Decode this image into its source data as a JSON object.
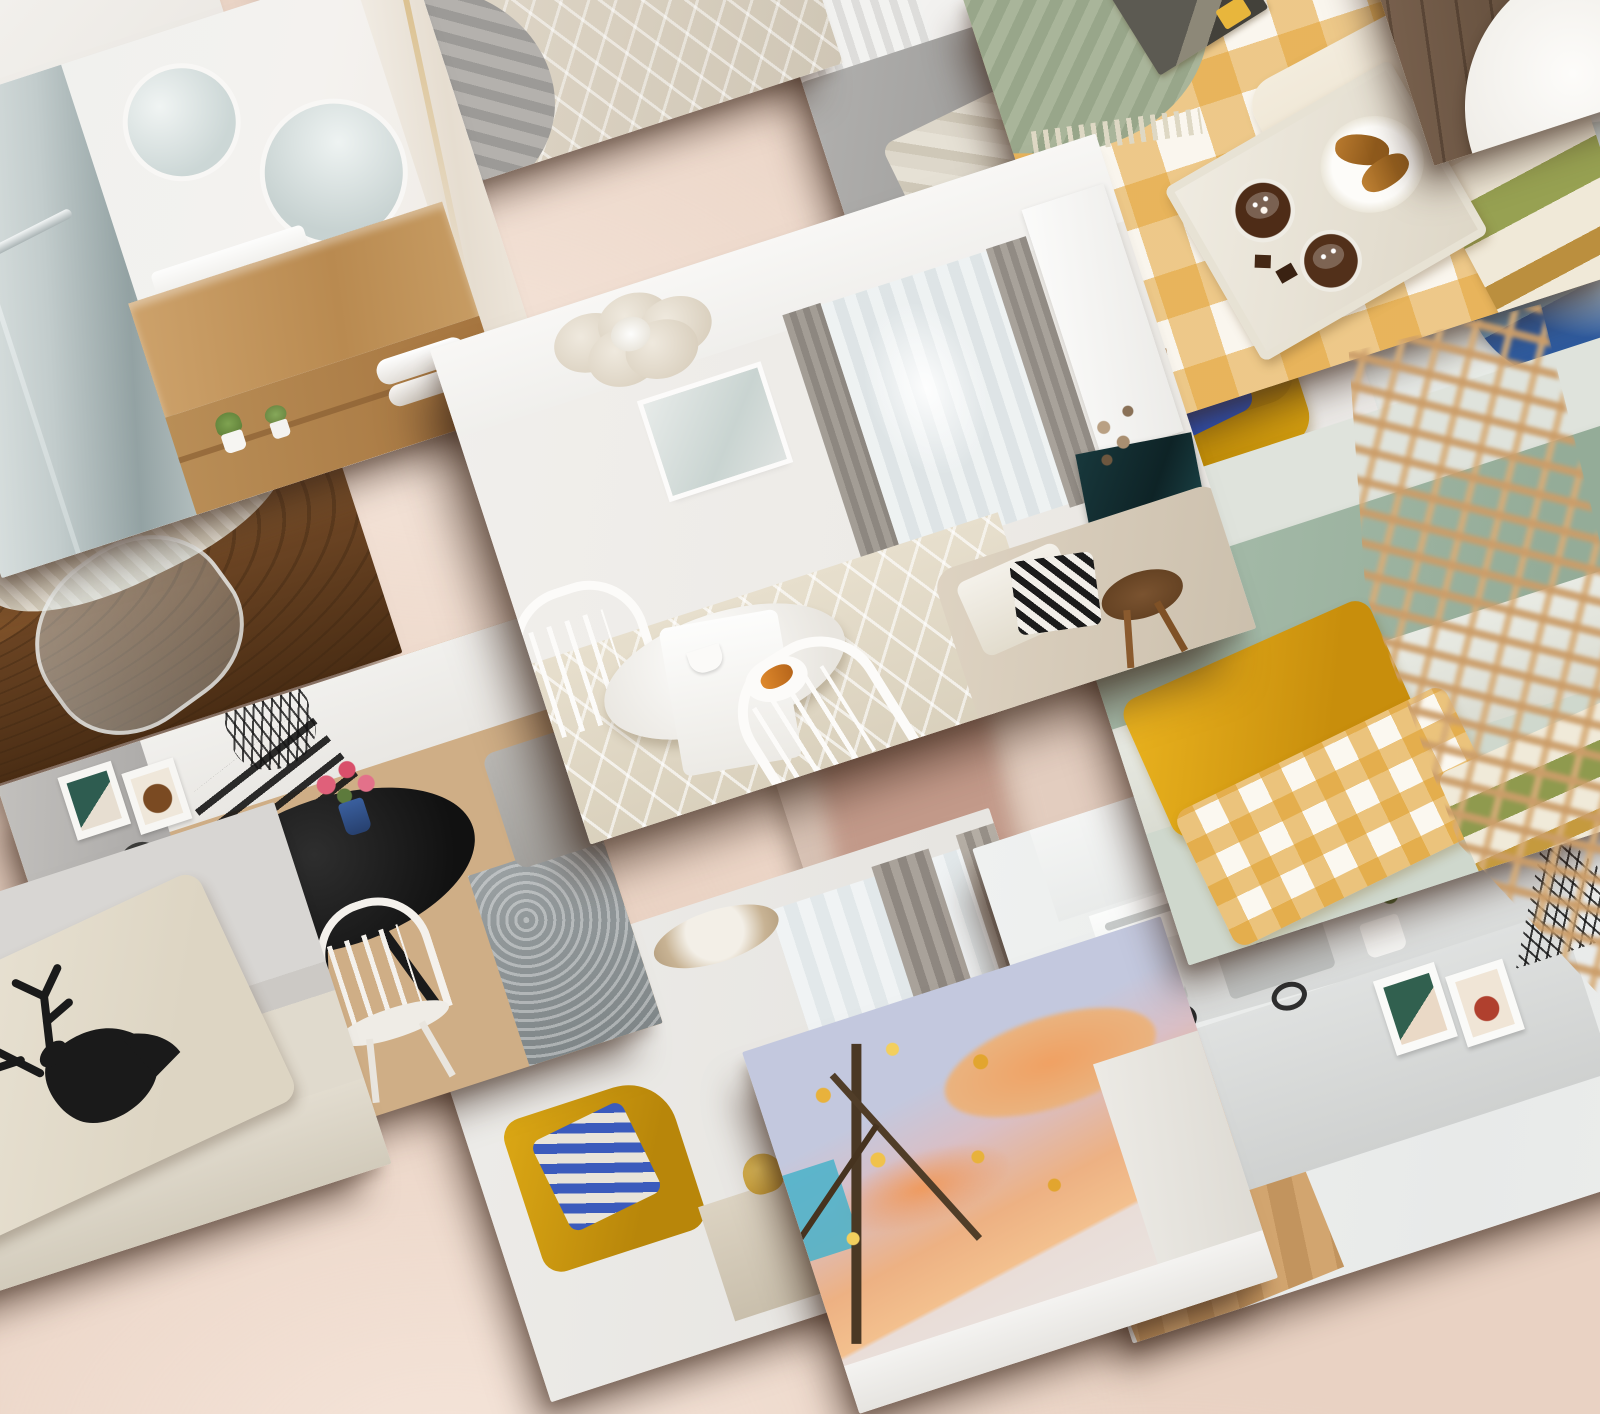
{
  "board": {
    "type": "interior-design photo collage mockup",
    "background_color": "#e9d2c3",
    "tile_rotation_deg": -18,
    "tile_shadow_color": "rgba(58,37,24,0.52)",
    "visible_text": "none"
  },
  "tiles": [
    {
      "id": "white-sliver",
      "label": "Bright white corner photo",
      "description": "Over-exposed white photo edge peeking at the very top-left corner",
      "palette": [
        "#fbfaf8",
        "#ece9e4"
      ]
    },
    {
      "id": "bathroom",
      "label": "Modern bathroom with walk-in shower",
      "description": "Glass shower enclosure with chrome handle, two round mirrors, light wood floating vanity with white basin, rolled towels and small potted plants, marble accent wall with gold veining",
      "palette": [
        "#aab7b8",
        "#f2f0ed",
        "#c9a06a",
        "#7fa351"
      ]
    },
    {
      "id": "rug-detail",
      "label": "Cream carved rug with stool legs",
      "description": "Close-up of a cream geometric-pile rug, angled wooden stool legs, grey knitted throw and a black-and-white diamond cushion on a grey couch edge",
      "palette": [
        "#e6dfd2",
        "#b5763a",
        "#9c9a97",
        "#141414"
      ]
    },
    {
      "id": "sofa-detail",
      "label": "Grey sofa with striped cushions",
      "description": "Grey fabric sofa beneath a white wall and radiator, cushions in mustard yellow with navy and red stripes, navy-and-white stripes, beige pinstripe, plus a glass vase",
      "palette": [
        "#a8a8a6",
        "#f6c91b",
        "#22356d",
        "#e23b2e"
      ]
    },
    {
      "id": "gingham-bed",
      "label": "Yellow gingham breakfast-in-bed",
      "description": "Bed with yellow-white buffalo-check duvet, sage green fringed throw, magazine, wooden tray holding two hot chocolates with marshmallows, chocolate squares and croissants on a fluted plate, boho tufted pillows with olive bands",
      "palette": [
        "#e3a436",
        "#faf6ee",
        "#a9b59a",
        "#4e2c17"
      ]
    },
    {
      "id": "wood-corner",
      "label": "Rustic wood with white bowl",
      "description": "Dark rustic plank surface with a large round white bowl, upper-right corner of the collage",
      "palette": [
        "#5c4836",
        "#f6f4f0"
      ]
    },
    {
      "id": "harbor-table",
      "label": "Live-edge table with berries and harbor print",
      "description": "Dark walnut live-edge table, white bowl of blueberries and raspberries, blurred glass pitcher, sheepskin fur, framed photo of harbor cranes against blue sky",
      "palette": [
        "#6e90ad",
        "#2c3540",
        "#6b4423",
        "#c24656",
        "#334364"
      ]
    },
    {
      "id": "center-living-room",
      "label": "Featured bright living room",
      "description": "Featured large tile: cream living room with petal flower ceiling lamp, sheer curtains with grey drapes, wall-mounted TV, white round dining table with breakfast croissants and coffee, white spindle chairs, beige sofa with diamond black-and-white pillow, diamond-pattern cream rug, walnut tripod coffee table and dried flowers",
      "palette": [
        "#f1efec",
        "#e7dfcd",
        "#9a958e",
        "#18383c",
        "#e08a2c"
      ]
    },
    {
      "id": "yellow-armchair",
      "label": "Mustard armchair with blue pillow",
      "description": "Mustard yellow wing armchair on wooden legs holding a royal-blue pillow with cream curved color-block pattern",
      "palette": [
        "#d9a513",
        "#2e55c4",
        "#f0e8d8"
      ]
    },
    {
      "id": "sage-bedroom",
      "label": "Sage green bedroom",
      "description": "Sage green upholstered headboard and wall, mustard yellow pillow, yellow gingham pillow, boho tufted pillow with olive band, rustic wooden bench with cream knitted decor",
      "palette": [
        "#a9bcab",
        "#e3a820",
        "#8f9a4e",
        "#9c6b3f"
      ]
    },
    {
      "id": "blue-art-plate",
      "label": "Blue watercolor art piece",
      "description": "Pale table with a round plate holding an abstract blue watercolor resin piece with orange speckles and thin dark streaks",
      "palette": [
        "#e9ecea",
        "#2f5b9e",
        "#e8956a"
      ]
    },
    {
      "id": "deer-pillow",
      "label": "Deer silhouette pillow",
      "description": "Cream boucle sofa with a beige pillow printed with a black deer head and antlers silhouette against a grey wall",
      "palette": [
        "#d8d6d3",
        "#e8e2d6",
        "#1a1a1a"
      ]
    },
    {
      "id": "dining-room",
      "label": "Scandinavian dining corner",
      "description": "Black round dining table with pink carnations in a blue vase, white spindle chairs and black chairs on herringbone wood floor, grey kitchen cabinet, two small framed prints, black wire ball pendant, mottled grey rug and grey sofa edge",
      "palette": [
        "#cfae86",
        "#171717",
        "#f4f1ec",
        "#e0607a",
        "#9aa0a2"
      ]
    },
    {
      "id": "curtain-living-room",
      "label": "Living room with grey drapes",
      "description": "Room with sheer curtains and grey drapes, beige oval ceiling lamp, mustard armchair with blue striped pillow, sideboard with zebra-striped vase, gold swan figure and dried sprigs",
      "palette": [
        "#edece9",
        "#a9a29a",
        "#dca815",
        "#3b5bbc"
      ]
    },
    {
      "id": "autumn-window",
      "label": "Autumn sunset view",
      "description": "View of an autumn tree with golden leaves against a building, peach and lavender sunset clouds, teal glass reflection, white window frame",
      "palette": [
        "#c3c8de",
        "#edb183",
        "#e8b23c",
        "#4a3824",
        "#49b2c9"
      ]
    },
    {
      "id": "kitchen",
      "label": "White kitchen with fruit basket",
      "description": "White and grey kitchen: upper cabinets, oven, coffee maker, sink with faucet, potted plant, lower cabinets with round black handles, wire basket of oranges with red and green apples, two framed prints, black wire cone pendant lamp, wood floor",
      "palette": [
        "#eff1f0",
        "#d9dbda",
        "#e88024",
        "#b01f1c",
        "#141414"
      ]
    },
    {
      "id": "blurred-frames",
      "label": "Out-of-focus pink frames",
      "description": "Blurred warm-pink photo tile sitting behind the featured tile",
      "palette": [
        "#dcc8bb",
        "#c39a8a"
      ]
    }
  ],
  "decor": {
    "rattan_lamp": {
      "label": "Rattan pendant lamp foreground",
      "description": "Blurred rattan lattice pendant lamp overlapping the right side of the collage in the foreground",
      "palette": [
        "#cb9d69",
        "#d6ac78"
      ]
    }
  }
}
